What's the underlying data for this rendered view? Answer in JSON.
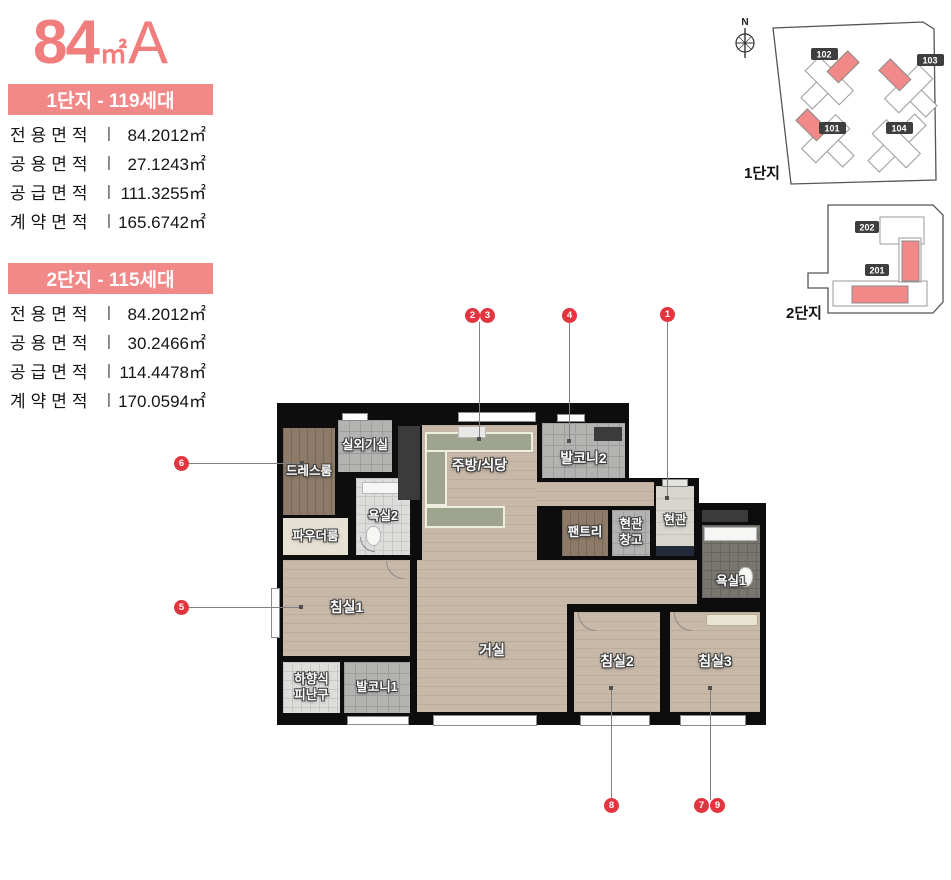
{
  "title": {
    "size": "84",
    "unit": "㎡",
    "variant": "A"
  },
  "sep": "|",
  "colors": {
    "accent_pink": "#f28989",
    "marker_red": "#e2353f",
    "wall_black": "#0d0d0d"
  },
  "complexes": [
    {
      "banner": "1단지 - 119세대",
      "rows": [
        {
          "label": "전용면적",
          "value": "84.2012㎡"
        },
        {
          "label": "공용면적",
          "value": "27.1243㎡"
        },
        {
          "label": "공급면적",
          "value": "111.3255㎡"
        },
        {
          "label": "계약면적",
          "value": "165.6742㎡"
        }
      ]
    },
    {
      "banner": "2단지 - 115세대",
      "rows": [
        {
          "label": "전용면적",
          "value": "84.2012㎡"
        },
        {
          "label": "공용면적",
          "value": "30.2466㎡"
        },
        {
          "label": "공급면적",
          "value": "114.4478㎡"
        },
        {
          "label": "계약면적",
          "value": "170.0594㎡"
        }
      ]
    }
  ],
  "siteplans": {
    "compass_n": "N",
    "site1": {
      "name": "1단지",
      "b101": "101",
      "b102": "102",
      "b103": "103",
      "b104": "104"
    },
    "site2": {
      "name": "2단지",
      "b201": "201",
      "b202": "202"
    }
  },
  "floorplan": {
    "rooms": {
      "outdoor_unit": "실외기실",
      "dress": "드레스룸",
      "powder": "파우더룸",
      "bath2": "욕실2",
      "kitchen": "주방/식당",
      "balcony2": "발코니2",
      "pantry": "팬트리",
      "entry_storage_1": "현관",
      "entry_storage_2": "창고",
      "entrance": "현관",
      "bath1": "욕실1",
      "bed1": "침실1",
      "living": "거실",
      "bed2": "침실2",
      "bed3": "침실3",
      "escape_1": "하향식",
      "escape_2": "피난구",
      "balcony1": "발코니1"
    },
    "markers": [
      "1",
      "2",
      "3",
      "4",
      "5",
      "6",
      "7",
      "8",
      "9"
    ]
  }
}
